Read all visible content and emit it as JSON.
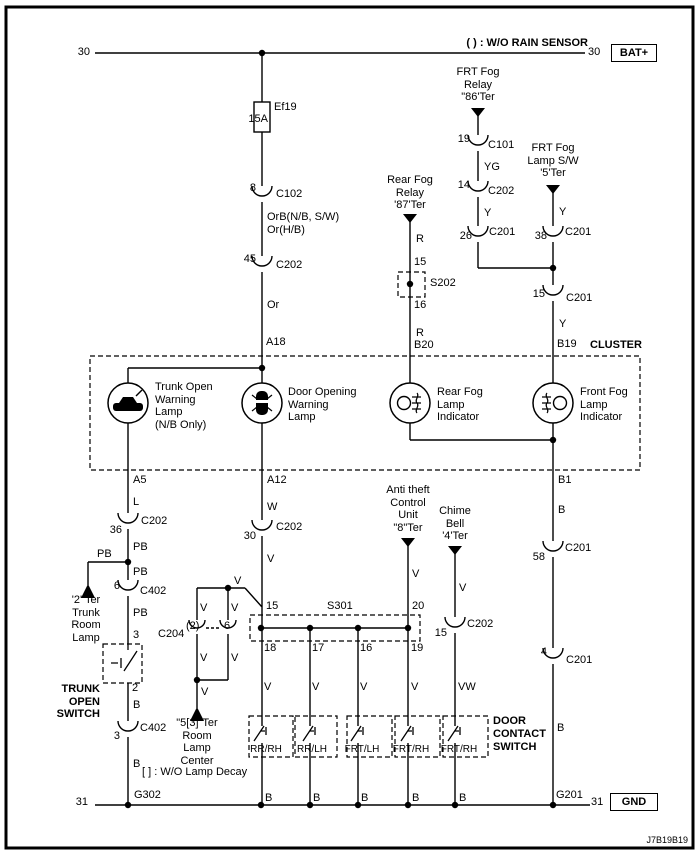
{
  "diagram": {
    "rain_note": "( ) : W/O RAIN SENSOR",
    "drawing_number": "J7B19B19",
    "colors": {
      "line": "#000000",
      "background": "#ffffff"
    }
  },
  "rails": {
    "top_left": "30",
    "top_right": "30",
    "bat": "BAT+",
    "bottom_left": "31",
    "bottom_right": "31",
    "gnd": "GND"
  },
  "fuse": {
    "name": "Ef19",
    "rating": "15A"
  },
  "components": {
    "frt_fog_relay": "FRT Fog\nRelay\n\"86'Ter",
    "frt_fog_lamp_sw": "FRT Fog\nLamp S/W\n'5'Ter",
    "rear_fog_relay": "Rear Fog\nRelay\n'87'Ter",
    "cluster": "CLUSTER",
    "trunk_open_warning_lamp": "Trunk Open\nWarning\nLamp\n(N/B Only)",
    "door_opening_warning_lamp": "Door Opening\nWarning\nLamp",
    "rear_fog_lamp_indicator": "Rear Fog\nLamp\nIndicator",
    "front_fog_lamp_indicator": "Front Fog\nLamp\nIndicator",
    "trunk_room_lamp": "'2' Ter\nTrunk\nRoom\nLamp",
    "trunk_open_switch": "TRUNK\nOPEN\nSWITCH",
    "anti_theft_unit": "Anti theft\nControl\nUnit\n\"8\"Ter",
    "chime_bell": "Chime\nBell\n'4'Ter",
    "room_lamp_center": "\"5[3]\"Ter\nRoom\nLamp\nCenter",
    "lamp_decay_note": "[ ] : W/O Lamp Decay",
    "door_contact_switch": "DOOR\nCONTACT\nSWITCH",
    "door_switches": [
      "RR/RH",
      "RR/LH",
      "FRT/LH",
      "FRT/RH",
      "FRT/RH"
    ]
  },
  "splices": {
    "s202": "S202",
    "s301": "S301"
  },
  "grounds": {
    "g302": "G302",
    "g201": "G201"
  },
  "connectors": {
    "c102": {
      "pin": "8",
      "name": "C102"
    },
    "c202_45": {
      "pin": "45",
      "name": "C202"
    },
    "c101_19": {
      "pin": "19",
      "name": "C101"
    },
    "c202_14": {
      "pin": "14",
      "name": "C202"
    },
    "c201_26": {
      "pin": "26",
      "name": "C201"
    },
    "c201_38": {
      "pin": "38",
      "name": "C201"
    },
    "c201_15": {
      "pin": "15",
      "name": "C201"
    },
    "c202_36": {
      "pin": "36",
      "name": "C202"
    },
    "c402_6": {
      "pin": "6",
      "name": "C402"
    },
    "c402_3": {
      "pin": "3",
      "name": "C402"
    },
    "c204": {
      "name": "C204",
      "pin_left": "(2)",
      "pin_right": "6"
    },
    "c202_30": {
      "pin": "30",
      "name": "C202"
    },
    "c202_15": {
      "pin": "15",
      "name": "C202"
    },
    "c201_58": {
      "pin": "58",
      "name": "C201"
    },
    "c201_4": {
      "pin": "4",
      "name": "C201"
    }
  },
  "pins": {
    "a18": "A18",
    "a5": "A5",
    "a12": "A12",
    "b20": "B20",
    "b19": "B19",
    "b1": "B1",
    "s202_top": "15",
    "s202_bot": "16",
    "s301_left": "15",
    "s301_right": "20",
    "s301_o1": "18",
    "s301_o2": "17",
    "s301_o3": "16",
    "s301_o4": "19",
    "trunk_sw_top": "3",
    "trunk_sw_bot": "2"
  },
  "wires": {
    "orb": "OrB(N/B, S/W)",
    "or_hb": "Or(H/B)",
    "or": "Or",
    "yg": "YG",
    "y_14": "Y",
    "y_sw": "Y",
    "y_b19": "Y",
    "r_top": "R",
    "r_bot": "R",
    "l": "L",
    "w": "W",
    "pb_1": "PB",
    "pb_branch": "PB",
    "pb_2": "PB",
    "pb_3": "PB",
    "v_main": "V",
    "v_branch": "V",
    "v_c204_l_top": "V",
    "v_c204_r_top": "V",
    "v_c204_l_bot": "V",
    "v_c204_r_bot": "V",
    "v_room": "V",
    "v_at": "V",
    "v_chime": "V",
    "v_18": "V",
    "v_17": "V",
    "v_16": "V",
    "v_19": "V",
    "vw": "VW",
    "b_b1": "B",
    "b_front_fog": "B",
    "b_trunk_sw": "B",
    "b_trunk_g": "B",
    "b_d18": "B",
    "b_d17": "B",
    "b_d16": "B",
    "b_d19": "B",
    "b_chime": "B"
  }
}
